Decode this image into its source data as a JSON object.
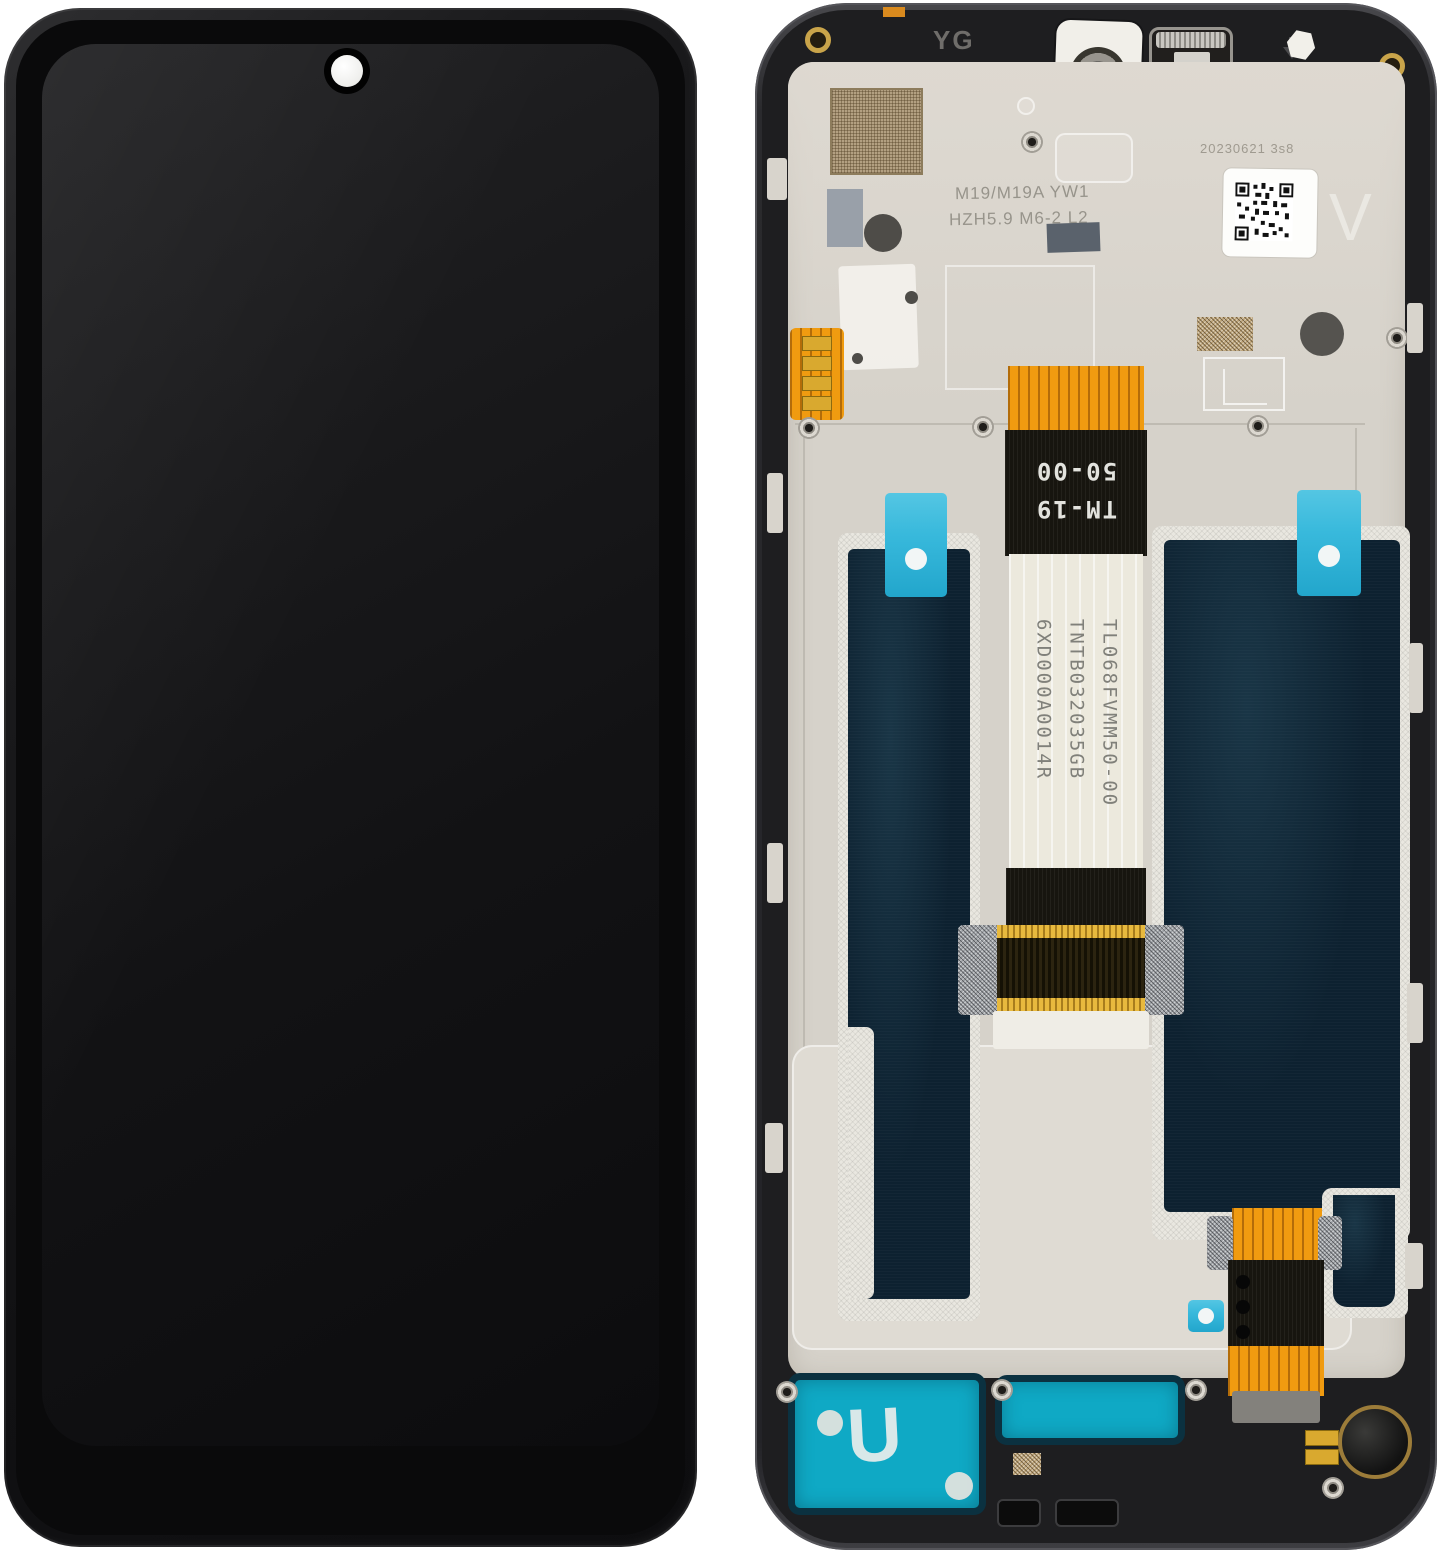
{
  "colors": {
    "page_bg": "#ffffff",
    "plate": "#d6d2ca",
    "plate_light": "#dfdbd3",
    "frame_dark": "#1e1e20",
    "graphite": "#0d2130",
    "adhesive_white": "#e9e7e0",
    "cyan_tab": "#38b9dc",
    "teal_sticker": "#0fa9c5",
    "teal_border": "#0b3140",
    "orange_flex": "#f09b10",
    "flex_black": "#17150f",
    "flex_label_white": "#ece9dd",
    "gold": "#c9a44a",
    "camera_red": "#e23838"
  },
  "back_view": {
    "top": {
      "yg_marking": "YG",
      "speaker_code": [
        "D513",
        "21243"
      ]
    },
    "plate": {
      "etch_lines": [
        "M19/M19A YW1",
        "HZH5.9 M6-2 L2"
      ],
      "date_stamp": "20230621 3s8",
      "version_marking": "V"
    },
    "main_flex": {
      "black_label_lines": [
        "TM-19",
        "50-00"
      ],
      "part_numbers": [
        "TL068FVMM50-00",
        "TNTB032035GB",
        "6XD000A0014R"
      ]
    },
    "bottom": {
      "mesh_letter": "U"
    }
  }
}
